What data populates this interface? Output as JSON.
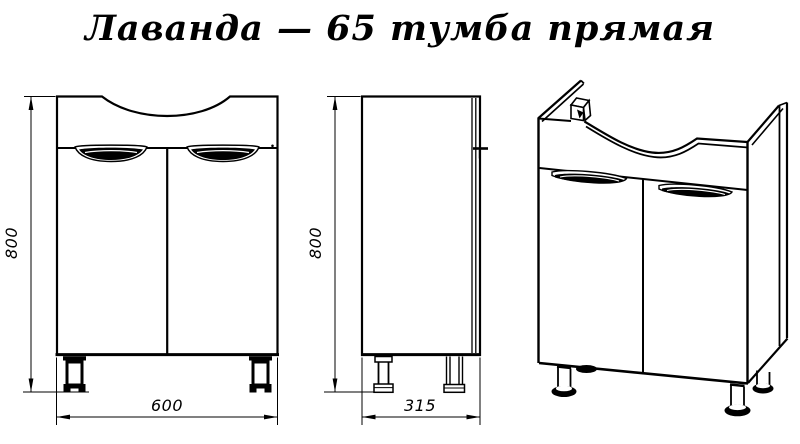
{
  "title": "Лаванда — 65 тумба прямая",
  "colors": {
    "line": "#000000",
    "background": "#ffffff"
  },
  "dimensions": {
    "front_height": "800",
    "front_width": "600",
    "side_height": "800",
    "side_depth": "315"
  }
}
